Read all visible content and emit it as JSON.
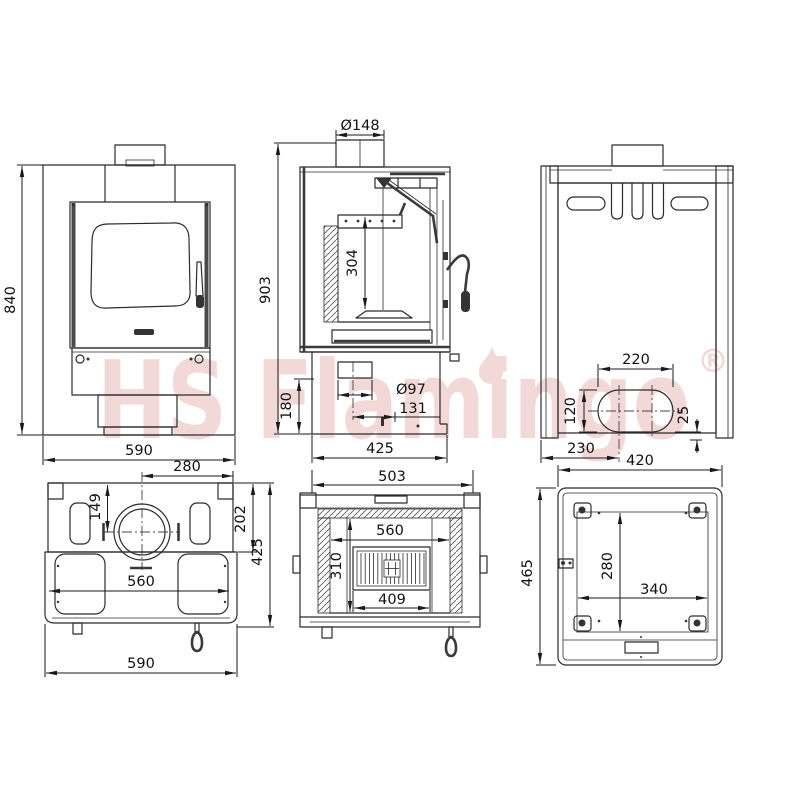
{
  "watermark": {
    "text": "HS Flamingo",
    "registered": "®",
    "color": "#f2d8d6"
  },
  "colors": {
    "line": "#2b2b2b",
    "dimension": "#1a1a1a",
    "background": "#ffffff"
  },
  "views": {
    "front": {
      "dim_height": "840",
      "dim_width": "590"
    },
    "section_side": {
      "dim_flue_diameter": "Ø148",
      "dim_total_height": "903",
      "dim_firebox_height": "304",
      "dim_base_height": "180",
      "dim_outlet_diameter": "Ø97",
      "dim_outlet_offset": "131",
      "dim_depth": "425"
    },
    "back": {
      "dim_oval_span": "220",
      "dim_oval_height": "120",
      "dim_bottom_clearance": "25",
      "dim_outlet_center": "230"
    },
    "top": {
      "dim_flue_to_right": "280",
      "dim_flue_to_back": "149",
      "dim_back_depth": "202",
      "dim_total_depth": "425",
      "dim_inner_width": "560",
      "dim_total_width": "590"
    },
    "section_front": {
      "dim_body_width": "503",
      "dim_inner_width": "560",
      "dim_inner_depth": "310",
      "dim_grate_width": "409"
    },
    "bottom": {
      "dim_width": "420",
      "dim_depth": "465",
      "dim_plate_depth": "280",
      "dim_plate_width": "340"
    }
  }
}
